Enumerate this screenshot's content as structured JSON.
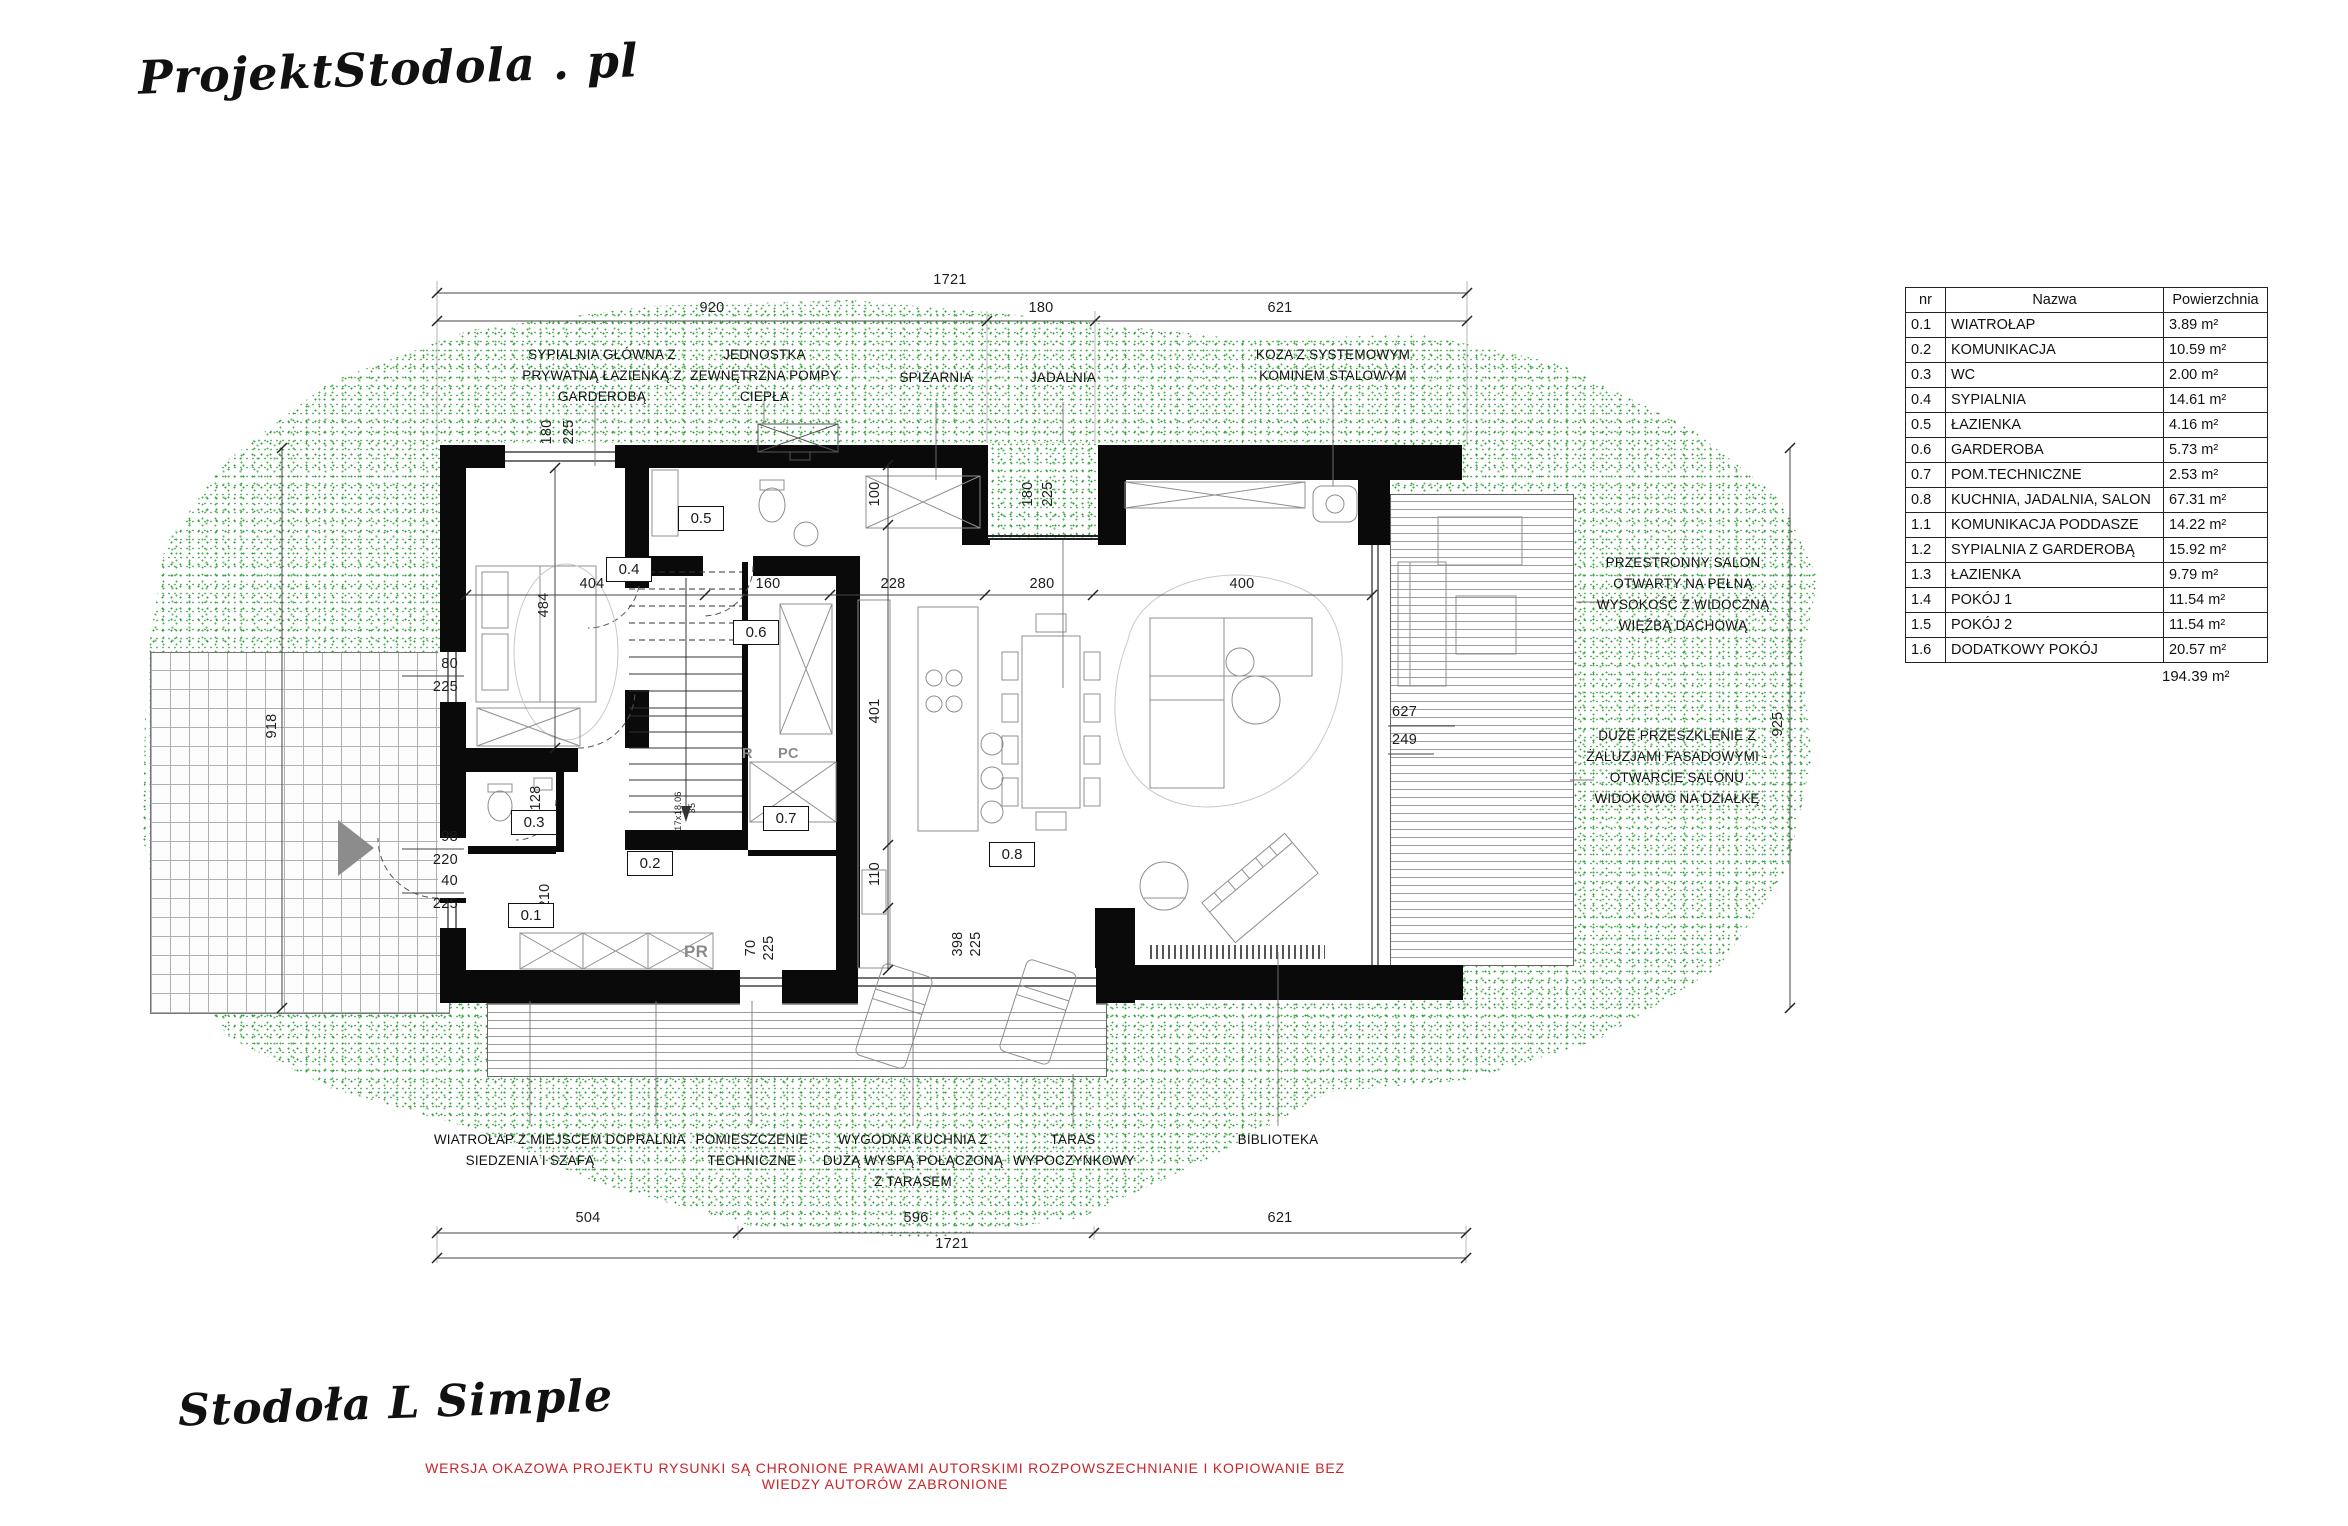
{
  "branding": {
    "logo": "ProjektStodola . pl",
    "project_title": "Stodoła L Simple",
    "disclaimer": "WERSJA OKAZOWA PROJEKTU RYSUNKI SĄ CHRONIONE PRAWAMI AUTORSKIMI ROZPOWSZECHNIANIE I KOPIOWANIE BEZ WIEDZY AUTORÓW ZABRONIONE"
  },
  "colors": {
    "grass": "#2e9e3e",
    "disclaimer_red": "#cc2328",
    "wall": "#000000"
  },
  "room_table": {
    "headers": {
      "nr": "nr",
      "name": "Nazwa",
      "area": "Powierzchnia"
    },
    "rows": [
      {
        "nr": "0.1",
        "name": "WIATROŁAP",
        "area": "3.89 m²"
      },
      {
        "nr": "0.2",
        "name": "KOMUNIKACJA",
        "area": "10.59 m²"
      },
      {
        "nr": "0.3",
        "name": "WC",
        "area": "2.00 m²"
      },
      {
        "nr": "0.4",
        "name": "SYPIALNIA",
        "area": "14.61 m²"
      },
      {
        "nr": "0.5",
        "name": "ŁAZIENKA",
        "area": "4.16 m²"
      },
      {
        "nr": "0.6",
        "name": "GARDEROBA",
        "area": "5.73 m²"
      },
      {
        "nr": "0.7",
        "name": "POM.TECHNICZNE",
        "area": "2.53 m²"
      },
      {
        "nr": "0.8",
        "name": "KUCHNIA, JADALNIA, SALON",
        "area": "67.31 m²"
      },
      {
        "nr": "1.1",
        "name": "KOMUNIKACJA PODDASZE",
        "area": "14.22 m²"
      },
      {
        "nr": "1.2",
        "name": "SYPIALNIA Z GARDEROBĄ",
        "area": "15.92 m²"
      },
      {
        "nr": "1.3",
        "name": "ŁAZIENKA",
        "area": "9.79 m²"
      },
      {
        "nr": "1.4",
        "name": "POKÓJ 1",
        "area": "11.54 m²"
      },
      {
        "nr": "1.5",
        "name": "POKÓJ 2",
        "area": "11.54 m²"
      },
      {
        "nr": "1.6",
        "name": "DODATKOWY POKÓJ",
        "area": "20.57 m²"
      }
    ],
    "total": "194.39 m²"
  },
  "rooms": [
    "0.1",
    "0.2",
    "0.3",
    "0.4",
    "0.5",
    "0.6",
    "0.7",
    "0.8"
  ],
  "annotations": {
    "top": [
      "SYPIALNIA GŁÓWNA Z PRYWATNĄ ŁAZIENKĄ Z GARDEROBĄ",
      "JEDNOSTKA ZEWNĘTRZNA POMPY CIEPŁA",
      "SPIŻARNIA",
      "JADALNIA",
      "KOZA Z SYSTEMOWYM KOMINEM STALOWYM"
    ],
    "right": [
      "PRZESTRONNY SALON OTWARTY NA PEŁNĄ WYSOKOŚĆ Z WIDOCZNĄ WIĘŹBĄ DACHOWĄ",
      "DUŻE PRZESZKLENIE Z ŻALUZJAMI FASADOWYMI - OTWARCIE SALONU WIDOKOWO NA DZIAŁKĘ"
    ],
    "bottom": [
      "WIATROŁAP Z MIEJSCEM DO SIEDZENIA I SZAFĄ",
      "PRALNIA",
      "POMIESZCZENIE TECHNICZNE",
      "WYGODNA KUCHNIA Z DUŻĄ WYSPĄ POŁĄCZONĄ Z TARASEM",
      "TARAS WYPOCZYNKOWY",
      "BIBLIOTEKA"
    ]
  },
  "dims": {
    "top_total": "1721",
    "top_seg": [
      "920",
      "180",
      "621"
    ],
    "bottom_seg": [
      "504",
      "596",
      "621"
    ],
    "bottom_total": "1721",
    "left_total": "918",
    "right_total": "925",
    "widths": [
      "404",
      "160",
      "228",
      "280",
      "400"
    ],
    "heights": [
      "100",
      "401",
      "110"
    ],
    "bed_height": "484",
    "deck_levels": [
      "627",
      "249"
    ],
    "win_top": [
      "180",
      "225"
    ],
    "win_niche": [
      "180",
      "225"
    ],
    "win_left_a": [
      "80",
      "225"
    ],
    "win_left_b": [
      "98",
      "220"
    ],
    "win_left_c": [
      "40",
      "225"
    ],
    "win_bottom_a": [
      "70",
      "225"
    ],
    "win_bottom_b": [
      "398",
      "225"
    ],
    "door_a": "128",
    "door_b": "210",
    "stairs": "17x18.06",
    "stair_width": "35"
  },
  "extra_labels": {
    "washer": "PR",
    "shelf_r": "R",
    "shelf_pc": "PC"
  }
}
